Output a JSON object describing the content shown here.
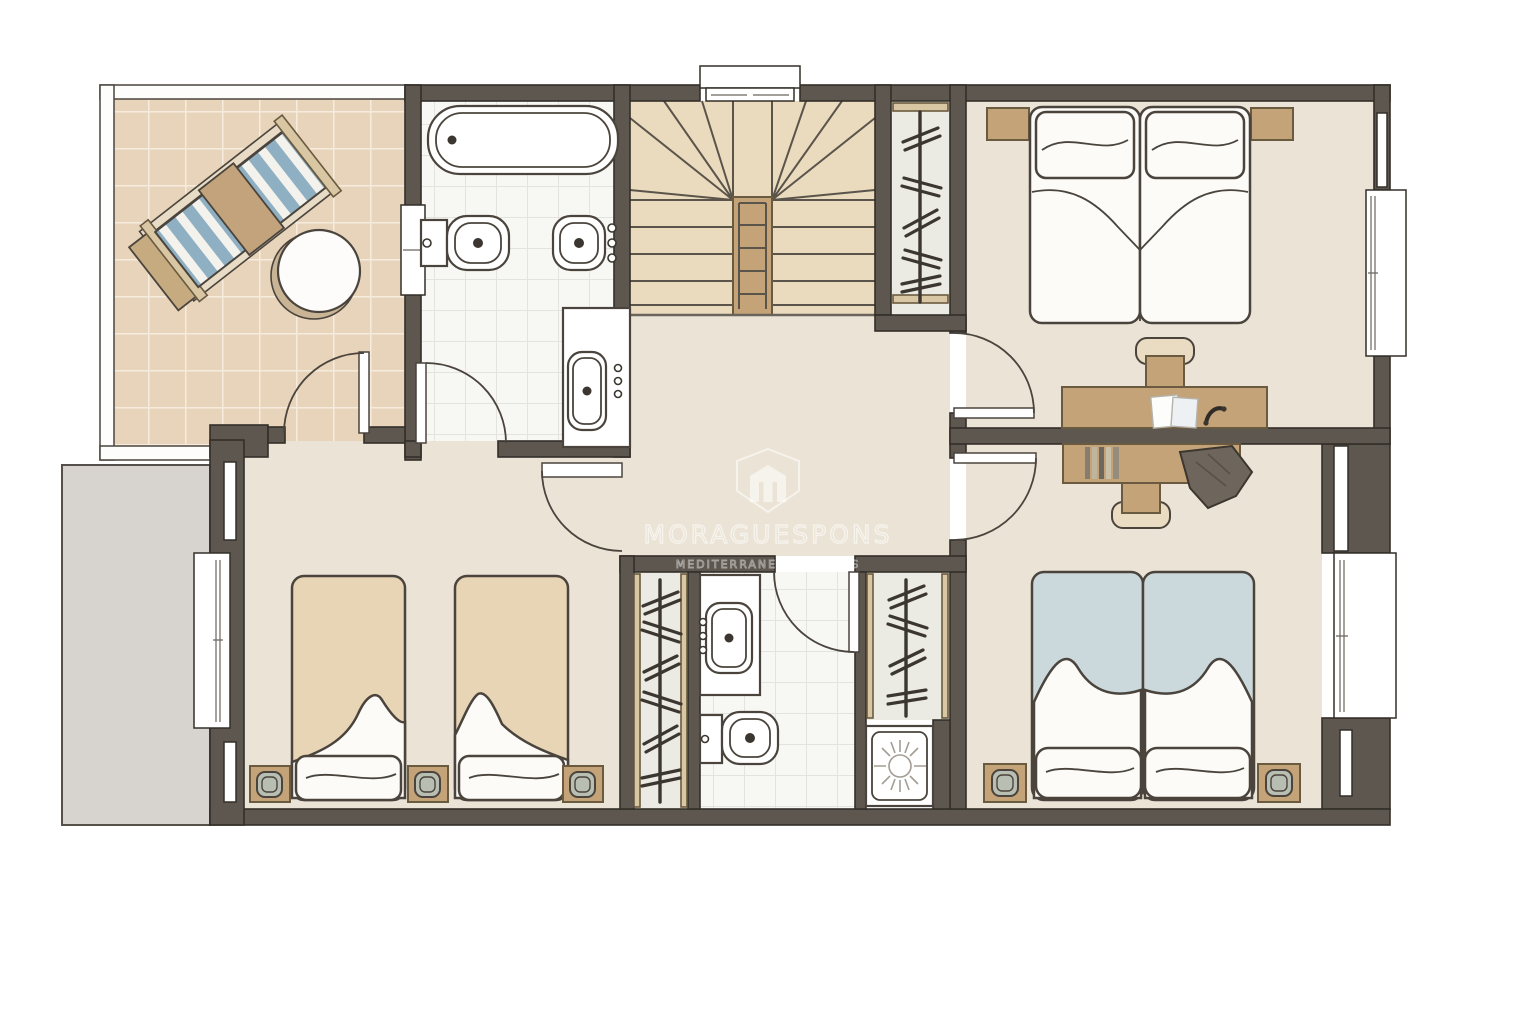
{
  "watermark": {
    "brand": "MORAGUESPONS",
    "tagline": "MEDITERRANEAN HOUSES",
    "logo": "m-shield-logo"
  },
  "colors": {
    "page": "#ffffff",
    "wall": "#5d5750",
    "wall_line": "#332f29",
    "floor": "#ebe4d6",
    "terrace_tile": "#e8d4ba",
    "terrace_grout": "#f5ecdd",
    "stair_floor": "#eadbbe",
    "bath_floor": "#f7f7f4",
    "bath_grid": "#e4e4de",
    "closet_floor": "#ecebe3",
    "exterior_gray": "#d7d3cf",
    "railing": "#fdfdfb",
    "wood": "#c3a377",
    "wood_line": "#6a5a40",
    "wood_light": "#d9c6a3",
    "linen": "#fcfbf8",
    "linen_line": "#4a443d",
    "blanket_tan": "#e7d5b6",
    "blanket_blue": "#ccd9dc",
    "stripe_blue": "#8fafc2",
    "lamp_shade": "#b8bfb2",
    "dark_accessory": "#6e665c",
    "sun_gray": "#a39d94"
  },
  "plan": {
    "type": "upper-floor-plan",
    "rooms": [
      "terrace",
      "bathroom",
      "staircase",
      "wardrobe",
      "bedroom-double",
      "landing",
      "bedroom-twin",
      "wardrobe",
      "bathroom",
      "wardrobe",
      "bedroom-double"
    ],
    "furniture": [
      "sun-lounger",
      "side-table",
      "bathtub",
      "toilet",
      "bidet",
      "washbasin",
      "staircase",
      "clothes-rail",
      "double-bed",
      "nightstand",
      "desk",
      "desk-chair",
      "papers",
      "telephone",
      "books",
      "jacket",
      "single-bed",
      "table-lamp",
      "shower",
      "window",
      "door"
    ]
  }
}
